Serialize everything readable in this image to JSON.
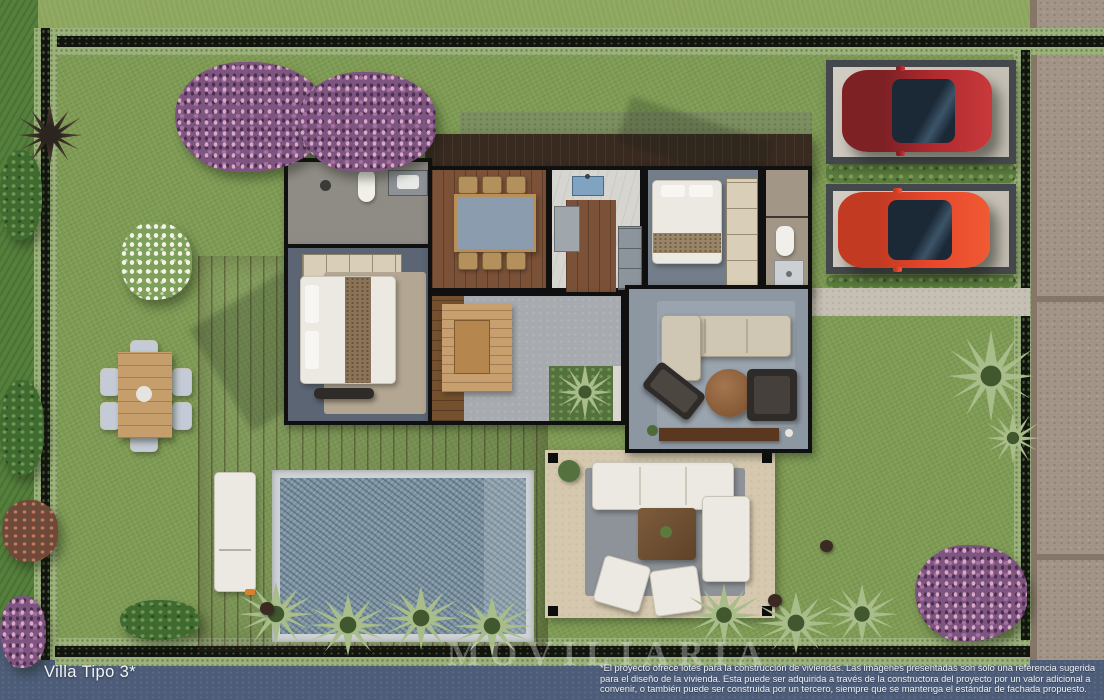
{
  "footer": {
    "villa_label": "Villa Tipo 3*",
    "disclaimer": "*El proyecto ofrece lotes para la construcción de viviendas. Las imágenes presentadas son solo una referencia sugerida para el diseño de la vivienda. Esta puede ser adquirida a través de la constructora del proyecto por un valor adicional a convenir, o también puede ser construida por un tercero, siempre que se mantenga el estándar de fachada propuesto."
  },
  "watermark": {
    "text": "MOVILIARIA"
  },
  "palette": {
    "lot_grass": "#7e9b53",
    "neighbor_grass": "#55803c",
    "hedge_light": "#9cb27b",
    "hedge_dark": "#12150d",
    "road": "#4d5d79",
    "sidewalk_cobble": "#a39488",
    "deck_wood": "#8a5a3e",
    "roof_wood": "#392a20",
    "pool_water": "#7e94a3",
    "pool_coping": "#ced2d5",
    "patio": "#d5c8ae",
    "car_dark_red": "#b02a2e",
    "car_orange_red": "#e8462b",
    "flower_purple": "#a670a0"
  }
}
